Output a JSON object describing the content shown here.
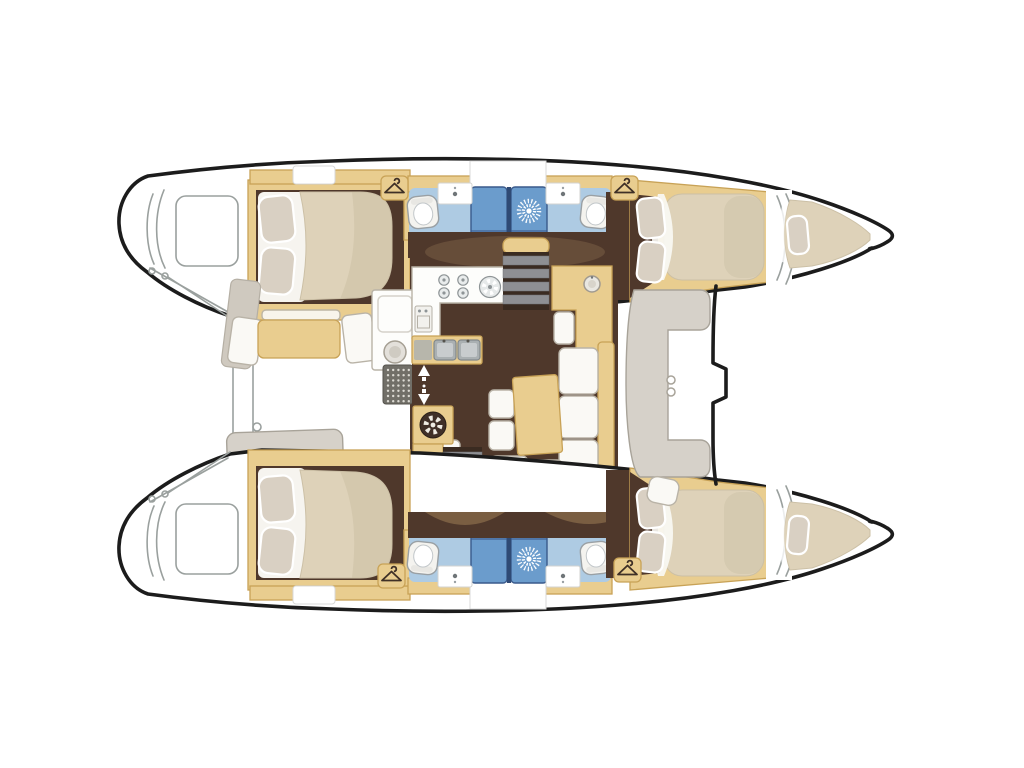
{
  "diagram": {
    "label": "Catamaran yacht deck and accommodation floor plan, top view",
    "type": "boat-floor-plan",
    "orientation": {
      "bow": "right",
      "stern": "left"
    },
    "hulls": [
      {
        "name": "upper hull",
        "spaces": [
          "aft double cabin with island berth and two pillows",
          "aft head with toilet, washbasin and shower stall",
          "forward head with shower stall, washbasin and toilet",
          "forward double cabin with island berth and two pillows",
          "forepeak berth in bow"
        ]
      },
      {
        "name": "lower hull",
        "spaces": [
          "aft double cabin with island berth and two pillows",
          "aft head with toilet, washbasin and shower stall",
          "forward head with shower stall, washbasin and toilet",
          "forward double cabin with island berth and two pillows",
          "forepeak berth in bow"
        ]
      }
    ],
    "bridge_deck": {
      "spaces": [
        "aft cockpit with dining table, white bench seats, outdoor module and low table",
        "galley with four-burner stove, round hob, oven and twin sinks",
        "saloon with L-shaped sofa, rectangular table and two stools",
        "chart table / wet bar unit with seat and round basin",
        "companionway stairs to each hull",
        "forward cockpit with C-shaped bench",
        "foredeck with mast step between the bows"
      ]
    },
    "equipment_icons": [
      "wardrobe-hanger-icon x4",
      "shower-rose-icon x4",
      "toilet-icon x4",
      "washbasin-icon x4",
      "stove-burners-icon",
      "round-hob-icon",
      "twin-sinks-icon",
      "oven-icon",
      "winch-icon",
      "deck-grate-icon",
      "door-direction-arrows-icon",
      "mast-step-notch",
      "transom-steps",
      "cleats"
    ],
    "counts": {
      "cabins": 4,
      "heads": 4,
      "forepeak_berths": 2,
      "shower_stalls": 4
    }
  },
  "colors": {
    "outline": "#1c1c1c",
    "line-soft": "#9aa09e",
    "wood": "#e9cd8f",
    "wood-dark": "#c8a256",
    "floor": "#4f382b",
    "floor-light": "#7d6248",
    "rug": "#b08e5f",
    "mattress": "#ded2b9",
    "mattress-shade": "#c9bda2",
    "pillow": "#d9d0c3",
    "white-furn": "#faf9f5",
    "furn-stroke": "#b9b3a7",
    "gray-bench": "#d6d1c9",
    "gray-bench-stroke": "#a8a399",
    "gray-panel": "#cfc9bf",
    "bath-floor": "#aecbe3",
    "shower": "#6b9ccc",
    "shower-dark": "#3a5a8c",
    "fixture": "#f4f3ef",
    "fixture-stroke": "#9aa0a4",
    "metal": "#aab0b2",
    "metal-dark": "#82888b",
    "step": "#3a2b21",
    "tread": "#8e8f93"
  }
}
